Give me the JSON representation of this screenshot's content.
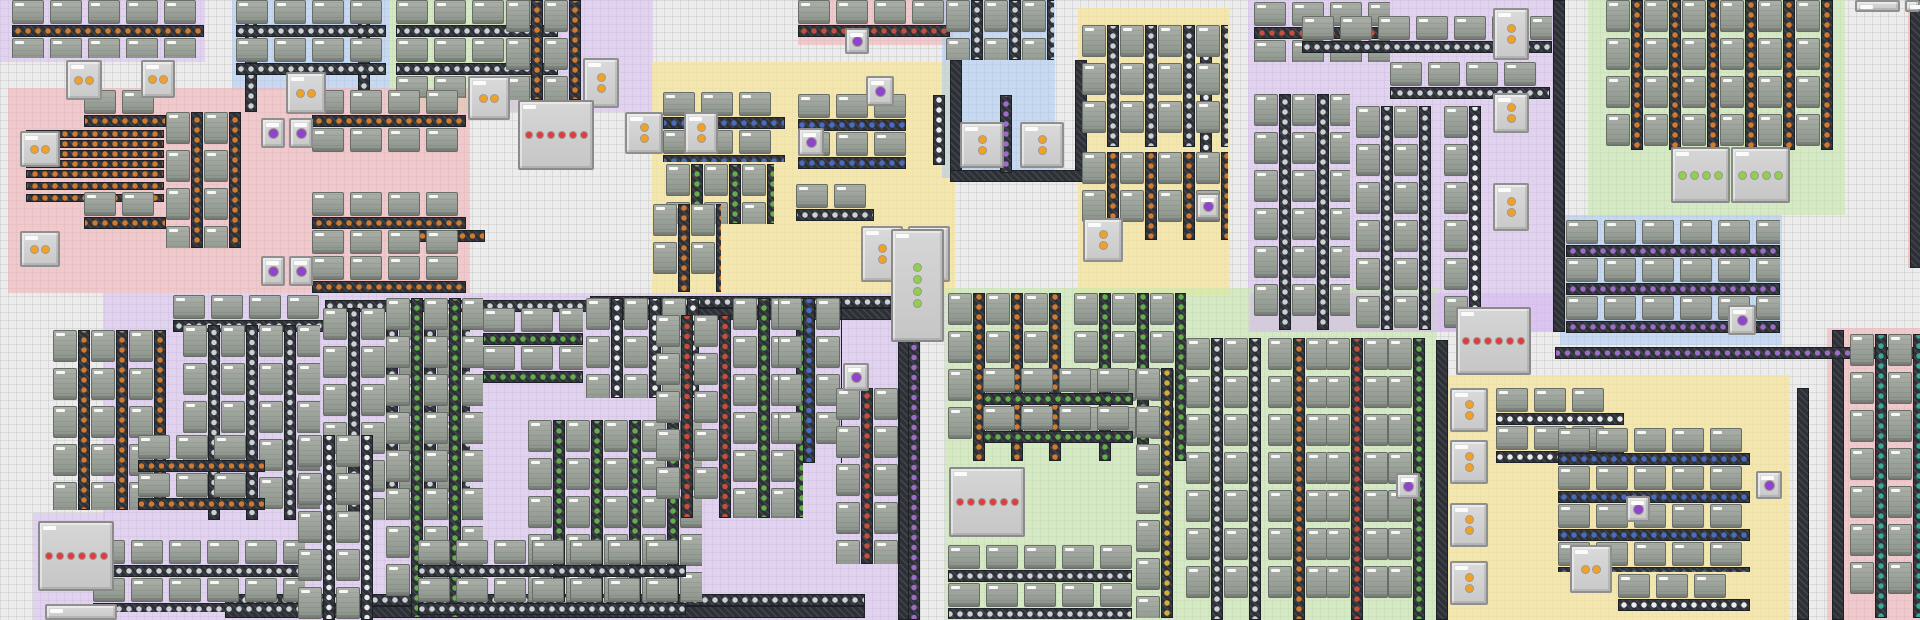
{
  "meta": {
    "view": "factory-map",
    "canvas_w": 1920,
    "canvas_h": 620,
    "grid_px": 8
  },
  "palette": {
    "bg": "#ececec",
    "grid_line": "#c3c3c3",
    "belt": "#2d3036",
    "belt_edge": "#1d2025",
    "machine": "#99a098",
    "machine_edge": "#686e67",
    "machine_cap": "#f7f7f7",
    "chest": "#d2d2d2",
    "chest_edge": "#8f8f8f",
    "zone_colors": {
      "pink": "rgba(244,178,184,0.60)",
      "lavender": "rgba(214,184,242,0.50)",
      "blue": "rgba(168,203,244,0.55)",
      "green": "rgba(200,232,172,0.60)",
      "yellow": "rgba(248,228,150,0.70)",
      "red": "rgba(246,165,165,0.60)"
    },
    "items": {
      "copper": "#d07a30",
      "iron": "#ccd1d5",
      "red": "#c4503c",
      "green": "#63ad4d",
      "blue": "#4a6cc0",
      "yellow": "#d2ae3e",
      "purple": "#9d6cc9",
      "white": "#e9ebed",
      "teal": "#3aa895"
    },
    "dots": {
      "orange": "#f2a127",
      "red": "#e23a3e",
      "green": "#8fd14f",
      "purple": "#8f45c9"
    }
  },
  "zones_schema": [
    "x",
    "y",
    "w",
    "h",
    "color"
  ],
  "zones": [
    [
      0,
      0,
      205,
      62,
      "lavender"
    ],
    [
      232,
      0,
      158,
      90,
      "blue"
    ],
    [
      390,
      0,
      170,
      112,
      "green"
    ],
    [
      505,
      0,
      148,
      112,
      "lavender"
    ],
    [
      8,
      88,
      462,
      205,
      "pink"
    ],
    [
      652,
      62,
      303,
      231,
      "yellow"
    ],
    [
      798,
      0,
      155,
      45,
      "pink"
    ],
    [
      942,
      0,
      113,
      178,
      "blue"
    ],
    [
      1078,
      8,
      152,
      287,
      "yellow"
    ],
    [
      1248,
      0,
      307,
      332,
      "lavender"
    ],
    [
      1588,
      0,
      257,
      215,
      "green"
    ],
    [
      1560,
      215,
      222,
      130,
      "blue"
    ],
    [
      1908,
      0,
      12,
      268,
      "red"
    ],
    [
      103,
      293,
      797,
      327,
      "lavender"
    ],
    [
      33,
      513,
      72,
      107,
      "lavender"
    ],
    [
      945,
      288,
      492,
      332,
      "green"
    ],
    [
      1250,
      293,
      330,
      39,
      "lavender"
    ],
    [
      1447,
      375,
      343,
      245,
      "yellow"
    ],
    [
      1827,
      328,
      93,
      292,
      "pink"
    ]
  ],
  "blocks_schema": [
    "x",
    "y",
    "w",
    "h",
    "orient",
    "belt_item"
  ],
  "blocks": [
    [
      12,
      0,
      192,
      58,
      "h",
      "copper"
    ],
    [
      236,
      0,
      150,
      88,
      "h",
      "iron"
    ],
    [
      396,
      0,
      162,
      98,
      "h",
      "iron"
    ],
    [
      506,
      0,
      92,
      100,
      "v",
      "copper"
    ],
    [
      84,
      90,
      82,
      50,
      "h",
      "copper"
    ],
    [
      84,
      192,
      82,
      52,
      "h",
      "copper"
    ],
    [
      166,
      112,
      78,
      136,
      "v",
      "copper"
    ],
    [
      312,
      90,
      154,
      62,
      "h",
      "copper"
    ],
    [
      312,
      192,
      154,
      62,
      "h",
      "copper"
    ],
    [
      312,
      256,
      154,
      38,
      "h",
      "copper"
    ],
    [
      663,
      92,
      122,
      70,
      "h",
      "blue"
    ],
    [
      666,
      164,
      108,
      60,
      "v",
      "green"
    ],
    [
      653,
      204,
      68,
      88,
      "v",
      "copper"
    ],
    [
      798,
      94,
      108,
      86,
      "h",
      "blue"
    ],
    [
      796,
      184,
      78,
      56,
      "h",
      "iron"
    ],
    [
      798,
      0,
      152,
      40,
      "h",
      "red"
    ],
    [
      946,
      0,
      108,
      60,
      "v",
      "iron"
    ],
    [
      1082,
      25,
      146,
      122,
      "v",
      "iron"
    ],
    [
      1082,
      152,
      146,
      88,
      "v",
      "copper"
    ],
    [
      1254,
      2,
      136,
      60,
      "h",
      "red"
    ],
    [
      1302,
      16,
      250,
      44,
      "h",
      "iron"
    ],
    [
      1390,
      62,
      160,
      44,
      "h",
      "iron"
    ],
    [
      1254,
      94,
      96,
      236,
      "v",
      "iron"
    ],
    [
      1356,
      106,
      92,
      224,
      "v",
      "iron"
    ],
    [
      1444,
      106,
      48,
      224,
      "v",
      "white"
    ],
    [
      1606,
      0,
      232,
      150,
      "v",
      "copper"
    ],
    [
      1566,
      220,
      214,
      122,
      "h",
      "purple"
    ],
    [
      173,
      295,
      152,
      45,
      "h",
      "iron"
    ],
    [
      53,
      330,
      127,
      180,
      "v",
      "copper"
    ],
    [
      183,
      325,
      137,
      195,
      "v",
      "iron"
    ],
    [
      323,
      308,
      147,
      212,
      "v",
      "iron"
    ],
    [
      138,
      435,
      127,
      85,
      "h",
      "copper"
    ],
    [
      93,
      540,
      212,
      72,
      "h",
      "iron"
    ],
    [
      298,
      435,
      88,
      185,
      "v",
      "white"
    ],
    [
      386,
      298,
      97,
      320,
      "v",
      "green"
    ],
    [
      483,
      308,
      100,
      88,
      "h",
      "green"
    ],
    [
      528,
      420,
      174,
      182,
      "v",
      "green"
    ],
    [
      586,
      298,
      120,
      100,
      "v",
      "white"
    ],
    [
      656,
      315,
      86,
      203,
      "v",
      "red"
    ],
    [
      733,
      298,
      70,
      220,
      "v",
      "green"
    ],
    [
      418,
      540,
      268,
      76,
      "h",
      "iron"
    ],
    [
      778,
      298,
      64,
      165,
      "v",
      "blue"
    ],
    [
      836,
      388,
      64,
      176,
      "v",
      "red"
    ],
    [
      948,
      293,
      124,
      168,
      "v",
      "copper"
    ],
    [
      1074,
      293,
      112,
      168,
      "v",
      "green"
    ],
    [
      983,
      368,
      150,
      94,
      "h",
      "green"
    ],
    [
      948,
      545,
      184,
      74,
      "h",
      "iron"
    ],
    [
      1136,
      368,
      50,
      250,
      "v",
      "yellow"
    ],
    [
      1186,
      338,
      82,
      282,
      "v",
      "iron"
    ],
    [
      1268,
      338,
      58,
      282,
      "v",
      "copper"
    ],
    [
      1326,
      338,
      62,
      282,
      "v",
      "red"
    ],
    [
      1388,
      338,
      48,
      282,
      "v",
      "green"
    ],
    [
      1496,
      388,
      128,
      82,
      "h",
      "white"
    ],
    [
      1558,
      428,
      192,
      144,
      "h",
      "blue"
    ],
    [
      1618,
      574,
      132,
      46,
      "h",
      "white"
    ],
    [
      1850,
      334,
      70,
      284,
      "v",
      "teal"
    ]
  ],
  "lanes_schema": [
    "x",
    "y",
    "w",
    "h",
    "orient",
    "belt_item",
    "count"
  ],
  "lanes": [
    [
      26,
      130,
      138,
      48,
      "h",
      "copper",
      5
    ],
    [
      26,
      182,
      138,
      20,
      "h",
      "copper",
      2
    ]
  ],
  "belts_schema": [
    "x",
    "y",
    "length",
    "orient",
    "belt_item"
  ],
  "belts": [
    [
      245,
      0,
      112,
      "v",
      "iron"
    ],
    [
      358,
      0,
      112,
      "v",
      "iron"
    ],
    [
      400,
      230,
      85,
      "h",
      "copper"
    ],
    [
      950,
      60,
      118,
      "v",
      "none"
    ],
    [
      1075,
      60,
      118,
      "v",
      "none"
    ],
    [
      950,
      170,
      137,
      "h",
      "none"
    ],
    [
      1000,
      95,
      78,
      "v",
      "purple"
    ],
    [
      933,
      95,
      70,
      "v",
      "white"
    ],
    [
      1553,
      0,
      332,
      "v",
      "none"
    ],
    [
      225,
      594,
      640,
      "h",
      "iron"
    ],
    [
      225,
      606,
      640,
      "h",
      "none"
    ],
    [
      898,
      295,
      325,
      "v",
      "none"
    ],
    [
      908,
      295,
      325,
      "v",
      "purple"
    ],
    [
      1436,
      340,
      280,
      "v",
      "none"
    ],
    [
      1797,
      388,
      232,
      "v",
      "none"
    ],
    [
      1832,
      330,
      290,
      "v",
      "none"
    ],
    [
      1555,
      347,
      365,
      "h",
      "purple"
    ],
    [
      1910,
      0,
      268,
      "v",
      "none"
    ],
    [
      590,
      296,
      315,
      "h",
      "iron"
    ],
    [
      590,
      308,
      315,
      "h",
      "none"
    ],
    [
      325,
      300,
      270,
      "h",
      "iron"
    ],
    [
      1200,
      30,
      135,
      "v",
      "white"
    ]
  ],
  "chests_schema": [
    "x",
    "y",
    "w",
    "h",
    "dot_color",
    "dot_count",
    "dot_dir"
  ],
  "chests": [
    [
      66,
      60,
      36,
      40,
      "orange",
      2,
      "h"
    ],
    [
      141,
      60,
      34,
      38,
      "orange",
      2,
      "h"
    ],
    [
      286,
      72,
      40,
      42,
      "orange",
      2,
      "h"
    ],
    [
      468,
      76,
      42,
      44,
      "orange",
      2,
      "h"
    ],
    [
      583,
      58,
      36,
      50,
      "orange",
      2,
      "v"
    ],
    [
      625,
      112,
      38,
      42,
      "orange",
      2,
      "v"
    ],
    [
      684,
      112,
      34,
      42,
      "orange",
      2,
      "v"
    ],
    [
      20,
      131,
      40,
      36,
      "orange",
      2,
      "h"
    ],
    [
      20,
      231,
      40,
      36,
      "orange",
      2,
      "h"
    ],
    [
      960,
      122,
      44,
      46,
      "orange",
      2,
      "v"
    ],
    [
      1020,
      122,
      44,
      46,
      "orange",
      2,
      "v"
    ],
    [
      861,
      226,
      42,
      56,
      "orange",
      2,
      "v"
    ],
    [
      908,
      226,
      42,
      56,
      "orange",
      2,
      "v"
    ],
    [
      1083,
      218,
      40,
      44,
      "orange",
      2,
      "v"
    ],
    [
      1493,
      8,
      36,
      52,
      "orange",
      2,
      "v"
    ],
    [
      1493,
      93,
      36,
      40,
      "orange",
      2,
      "v"
    ],
    [
      1493,
      183,
      36,
      48,
      "orange",
      2,
      "v"
    ],
    [
      1450,
      388,
      38,
      44,
      "orange",
      2,
      "v"
    ],
    [
      1450,
      440,
      38,
      44,
      "orange",
      2,
      "v"
    ],
    [
      1450,
      503,
      38,
      44,
      "orange",
      2,
      "v"
    ],
    [
      1450,
      561,
      38,
      44,
      "orange",
      2,
      "v"
    ],
    [
      1570,
      545,
      42,
      48,
      "orange",
      2,
      "h"
    ],
    [
      261,
      118,
      24,
      30,
      "purple",
      1,
      "h"
    ],
    [
      289,
      118,
      24,
      30,
      "purple",
      1,
      "h"
    ],
    [
      261,
      256,
      24,
      30,
      "purple",
      1,
      "h"
    ],
    [
      289,
      256,
      24,
      30,
      "purple",
      1,
      "h"
    ],
    [
      845,
      28,
      24,
      26,
      "purple",
      1,
      "h"
    ],
    [
      866,
      76,
      28,
      30,
      "purple",
      1,
      "h"
    ],
    [
      798,
      128,
      26,
      28,
      "purple",
      1,
      "h"
    ],
    [
      1196,
      193,
      24,
      26,
      "purple",
      1,
      "h"
    ],
    [
      843,
      363,
      26,
      28,
      "purple",
      1,
      "h"
    ],
    [
      1396,
      473,
      24,
      26,
      "purple",
      1,
      "h"
    ],
    [
      1626,
      496,
      24,
      26,
      "purple",
      1,
      "h"
    ],
    [
      1756,
      471,
      26,
      28,
      "purple",
      1,
      "h"
    ],
    [
      1728,
      305,
      28,
      30,
      "purple",
      1,
      "h"
    ],
    [
      1855,
      0,
      45,
      12,
      "none",
      0,
      "h"
    ],
    [
      1905,
      0,
      15,
      12,
      "none",
      0,
      "h"
    ],
    [
      45,
      604,
      72,
      16,
      "none",
      0,
      "h"
    ]
  ],
  "bigboxes_schema": [
    "x",
    "y",
    "w",
    "h",
    "dot_color",
    "dot_count",
    "dot_dir"
  ],
  "bigboxes": [
    [
      518,
      100,
      76,
      70,
      "red",
      6,
      "h"
    ],
    [
      38,
      521,
      76,
      70,
      "red",
      6,
      "h"
    ],
    [
      949,
      467,
      76,
      70,
      "red",
      6,
      "h"
    ],
    [
      1456,
      307,
      75,
      68,
      "red",
      6,
      "h"
    ],
    [
      1671,
      147,
      59,
      56,
      "green",
      4,
      "h"
    ],
    [
      1731,
      147,
      59,
      56,
      "green",
      4,
      "h"
    ],
    [
      891,
      229,
      53,
      113,
      "green",
      4,
      "v"
    ]
  ]
}
